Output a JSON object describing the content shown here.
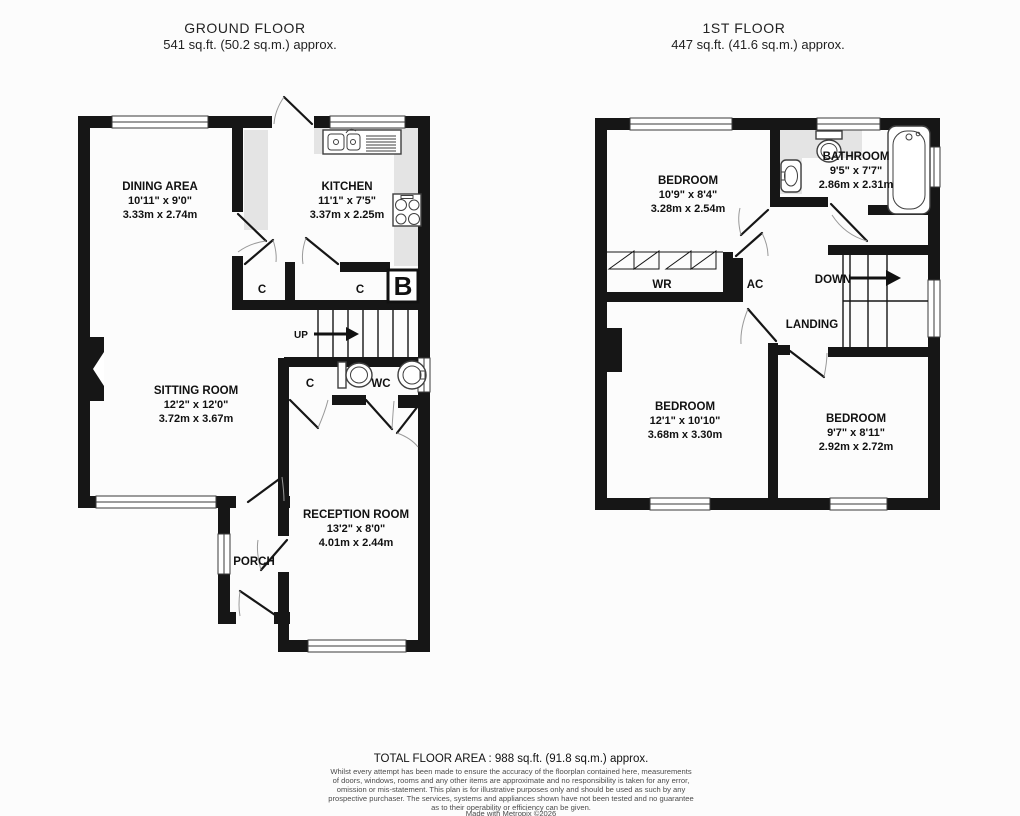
{
  "ground_floor": {
    "title": "GROUND FLOOR",
    "area": "541 sq.ft. (50.2 sq.m.) approx.",
    "rooms": {
      "dining": {
        "name": "DINING AREA",
        "imperial": "10'11\" x 9'0\"",
        "metric": "3.33m x 2.74m"
      },
      "kitchen": {
        "name": "KITCHEN",
        "imperial": "11'1\" x 7'5\"",
        "metric": "3.37m x 2.25m"
      },
      "sitting": {
        "name": "SITTING ROOM",
        "imperial": "12'2\" x 12'0\"",
        "metric": "3.72m x 3.67m"
      },
      "reception": {
        "name": "RECEPTION ROOM",
        "imperial": "13'2\" x 8'0\"",
        "metric": "4.01m x 2.44m"
      },
      "porch": {
        "name": "PORCH"
      },
      "wc": {
        "name": "WC"
      }
    },
    "labels": {
      "up": "UP",
      "closet1": "C",
      "closet2": "C",
      "closet3": "C",
      "boiler": "B"
    }
  },
  "first_floor": {
    "title": "1ST FLOOR",
    "area": "447 sq.ft. (41.6 sq.m.) approx.",
    "rooms": {
      "bedroom1": {
        "name": "BEDROOM",
        "imperial": "10'9\" x 8'4\"",
        "metric": "3.28m x 2.54m"
      },
      "bathroom": {
        "name": "BATHROOM",
        "imperial": "9'5\" x 7'7\"",
        "metric": "2.86m x 2.31m"
      },
      "bedroom2": {
        "name": "BEDROOM",
        "imperial": "12'1\" x 10'10\"",
        "metric": "3.68m x 3.30m"
      },
      "bedroom3": {
        "name": "BEDROOM",
        "imperial": "9'7\" x 8'11\"",
        "metric": "2.92m x 2.72m"
      },
      "landing": {
        "name": "LANDING"
      }
    },
    "labels": {
      "down": "DOWN",
      "wardrobe": "WR",
      "airing_cupboard": "AC"
    }
  },
  "footer": {
    "total_area": "TOTAL FLOOR AREA : 988 sq.ft. (91.8 sq.m.) approx.",
    "disclaimer": [
      "Whilst every attempt has been made to ensure the accuracy of the floorplan contained here, measurements",
      "of doors, windows, rooms and any other items are approximate and no responsibility is taken for any error,",
      "omission or mis-statement. This plan is for illustrative purposes only and should be used as such by any",
      "prospective purchaser. The services, systems and appliances shown have not been tested and no guarantee",
      "as to their operability or efficiency can be given."
    ],
    "credit": "Made with Metropix ©2026"
  },
  "colors": {
    "wall": "#161616",
    "counter_shading": "#e4e4e4",
    "background": "#fcfcfc",
    "text": "#111111"
  }
}
